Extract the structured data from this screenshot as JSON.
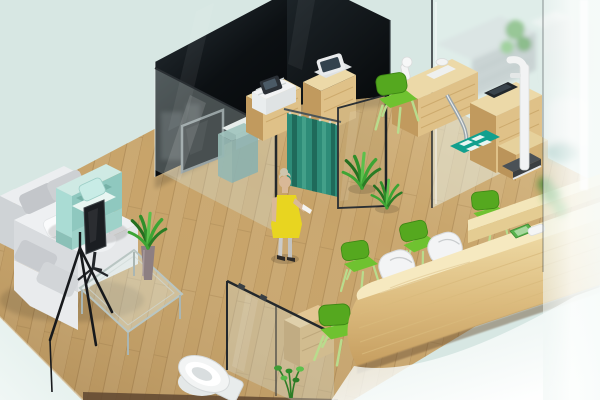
{
  "scene": {
    "type": "3d-isometric-interior-render",
    "setting": "clinic / office interior floor-plan visualization",
    "view": "isometric bird's-eye, cropped",
    "rooms": [
      "waiting-lounge",
      "consultation-room-with-curtain",
      "exam-room",
      "reception-corridor",
      "bathroom",
      "frosted-back-office"
    ]
  },
  "palette": {
    "bg_mint": "#d7e7e3",
    "bg_mint_light": "#edf6f3",
    "floor_wood": "#c7a369",
    "floor_seam": "#a5824e",
    "floor_edge_dark": "#5f4630",
    "wall_dark": "#11161a",
    "tv_screen": "#0b0e11",
    "tv_frame": "#7d8689",
    "glass_fill": "rgba(214,233,229,0.30)",
    "glass_edge": "#23282c",
    "curtain_teal": "#2e8c78",
    "curtain_dark": "#1f6a5a",
    "curtain_light": "#43a089",
    "wood_top": "#ecd9a8",
    "wood_face": "#dfc188",
    "wood_side": "#c19a5e",
    "counter_top": "#f6e9c0",
    "green_chair": "#55a81f",
    "green_chair_light": "#6fc230",
    "chair_legs": "#b9dc8d",
    "mint_chair": "#aadcd4",
    "mint_chair_inner": "#8fc8bf",
    "sofa_white": "#eef0f2",
    "sofa_gray": "#c9ccd0",
    "person_dress": "#e8d520",
    "person_hair": "#cfc5ad",
    "person_skin": "#d9b897",
    "mat_teal": "#12a08e",
    "plant_green": "#2f8f2a",
    "plant_light": "#5cc04c",
    "scale_base": "#3b3f42",
    "device_white": "#f2f3f4",
    "teal_cabinet": "#6e9a96",
    "dish_green": "#58b24c"
  },
  "objects": [
    {
      "name": "wood-floor",
      "label": "wooden plank floor"
    },
    {
      "name": "partition-wall-left",
      "label": "dark tinted glass partition with wall TV"
    },
    {
      "name": "partition-wall-right",
      "label": "dark tinted glass partition"
    },
    {
      "name": "privacy-curtain",
      "label": "teal privacy curtain in doorway"
    },
    {
      "name": "person",
      "label": "elderly woman in yellow dress at curtain"
    },
    {
      "name": "waiting-sofa",
      "label": "white sectional sofa"
    },
    {
      "name": "mint-armchair",
      "label": "mint cube armchair"
    },
    {
      "name": "office-chair",
      "label": "black office chair"
    },
    {
      "name": "display-easel",
      "label": "black tripod display stand"
    },
    {
      "name": "coffee-table",
      "label": "glass coffee table with aloe vase"
    },
    {
      "name": "printer-cabinet-1",
      "label": "wood cabinet with printer"
    },
    {
      "name": "printer-cabinet-2",
      "label": "wood cabinet with terminal"
    },
    {
      "name": "exam-desk",
      "label": "pine exam desk with instruments"
    },
    {
      "name": "stadiometer",
      "label": "height measuring scale"
    },
    {
      "name": "scale-mat",
      "label": "teal weighing mat"
    },
    {
      "name": "exam-chair",
      "label": "green exam chair"
    },
    {
      "name": "visitor-chairs",
      "label": "green corridor chairs (4)"
    },
    {
      "name": "staff-chairs",
      "label": "white reception tub chairs (2)"
    },
    {
      "name": "reception-counter",
      "label": "long pine reception counter"
    },
    {
      "name": "counter-items",
      "label": "green dish and white phone on counter"
    },
    {
      "name": "bathroom-glass",
      "label": "bathroom glass partition"
    },
    {
      "name": "toilet",
      "label": "white toilet"
    },
    {
      "name": "bathroom-shelf",
      "label": "wooden shelf unit"
    },
    {
      "name": "floor-plants",
      "label": "potted spiky plants"
    },
    {
      "name": "frosted-wall",
      "label": "frosted glass wall hiding back office"
    }
  ]
}
